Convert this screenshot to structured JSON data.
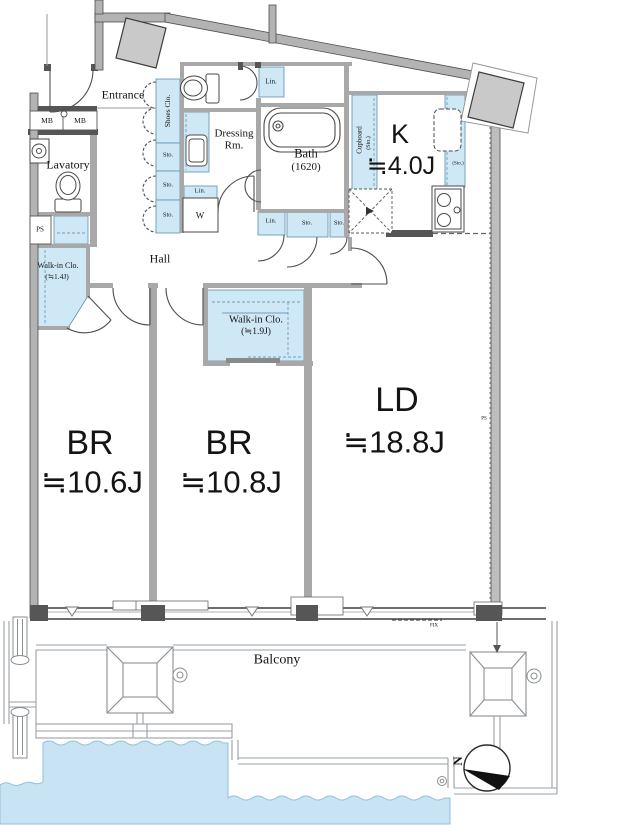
{
  "plan_type": "apartment-floorplan",
  "colors": {
    "fixture_blue": "#cfe8f5",
    "water_blue": "#c8e4f4",
    "wall_gray": "#b3b3b3",
    "wall_dark": "#565656",
    "line_gray": "#9aa0a4"
  },
  "rooms": {
    "entrance": {
      "label": "Entrance"
    },
    "lavatory": {
      "label": "Lavatory"
    },
    "hall": {
      "label": "Hall"
    },
    "dressing": {
      "label": "Dressing Rm."
    },
    "bath": {
      "label": "Bath",
      "size": "(1620)"
    },
    "kitchen": {
      "label": "K",
      "size": "≒4.0J"
    },
    "walkin_small": {
      "label": "Walk-in Clo.",
      "size": "(≒1.4J)"
    },
    "walkin_large": {
      "label": "Walk-in Clo.",
      "size": "(≒1.9J)"
    },
    "bedroom1": {
      "label": "BR",
      "size": "≒10.6J"
    },
    "bedroom2": {
      "label": "BR",
      "size": "≒10.8J"
    },
    "living": {
      "label": "LD",
      "size": "≒18.8J"
    },
    "balcony": {
      "label": "Balcony"
    }
  },
  "fixtures": {
    "meter_box_1": "MB",
    "meter_box_2": "MB",
    "pipe_space_left": "PS",
    "pipe_space_right": "PS",
    "shoes_closet": "Shoes Clo.",
    "storage_1": "Sto.",
    "storage_2": "Sto.",
    "storage_3": "Sto.",
    "linen_dressing": "Lin.",
    "linen_top": "Lin.",
    "linen_hall": "Lin.",
    "storage_hall_1": "Sto.",
    "storage_hall_2": "Sto.",
    "washer": "W",
    "cupboard": "Cupboard",
    "cupboard_sub": "(Sto.)",
    "fridge_space": "(Sto.)",
    "fixed_window": "FIX",
    "compass_north": "N"
  }
}
